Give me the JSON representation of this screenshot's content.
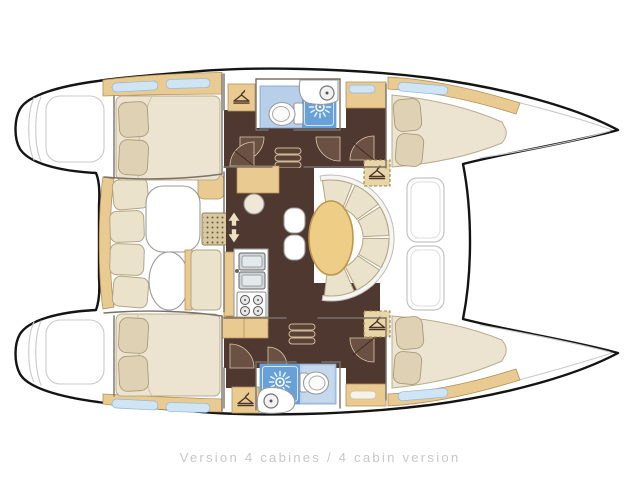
{
  "caption": "Version 4 cabines / 4 cabin version",
  "palette": {
    "bg": "#ffffff",
    "hull-outline": "#141414",
    "deck-line": "#c9c9c9",
    "wall": "#7a7168",
    "wood": "#e9cb92",
    "wood-dark": "#b3905a",
    "floor": "#4e382f",
    "floor-light": "#6b5044",
    "cushion": "#ebe2cb",
    "cushion-edge": "#b2a684",
    "pillow": "#dfd2b4",
    "mattress": "#ece4d0",
    "bath-floor": "#b7cfe9",
    "shower-blue": "#68a1d7",
    "table": "#eecd86",
    "table-edge": "#bd964e",
    "window": "#cfe4f4",
    "caption-color": "#c7c7c7"
  },
  "icons": {
    "hanger": "clothes-hanger-icon",
    "shower": "shower-rose-icon",
    "toilet": "toilet-icon",
    "basin": "round-basin-icon",
    "galley_sink": "double-sink-icon",
    "stove": "four-burner-stove-icon",
    "door_arrows": "sliding-door-arrows-icon",
    "window_slit": "hull-window-icon",
    "door_swing": "door-swing-icon"
  }
}
